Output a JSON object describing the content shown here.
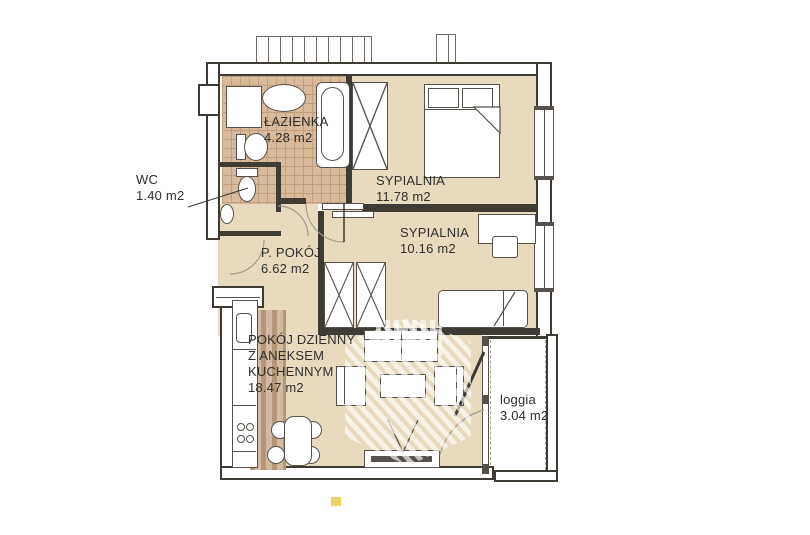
{
  "plan_type": "apartment-floor-plan",
  "rooms": [
    {
      "id": "lazienka",
      "name": "ŁAZIENKA",
      "area": "4.28 m2"
    },
    {
      "id": "wc",
      "name": "WC",
      "area": "1.40 m2"
    },
    {
      "id": "sypialnia-1",
      "name": "SYPIALNIA",
      "area": "11.78 m2"
    },
    {
      "id": "sypialnia-2",
      "name": "SYPIALNIA",
      "area": "10.16 m2"
    },
    {
      "id": "p-pokoj",
      "name": "P. POKÓJ",
      "area": "6.62 m2"
    },
    {
      "id": "pokoj-dzienny",
      "name": "POKÓJ DZIENNY\nZ ANEKSEM\nKUCHENNYM",
      "area": "18.47 m2"
    },
    {
      "id": "loggia",
      "name": "loggia",
      "area": "3.04 m2"
    }
  ],
  "colors": {
    "floor": "#e8dabe",
    "bath_tile": "#d7bb9c",
    "tile_grid": "#c19e7c",
    "wall": "#3e3a34",
    "kitchen_stripe_dark": "#b49678",
    "kitchen_stripe_light": "#d2bca1",
    "accent_dot": "#ecd362",
    "watermark": "#ffffff"
  },
  "furniture_icons": [
    "washing-machine-icon",
    "washbasin-icon",
    "toilet-icon",
    "bathtub-icon",
    "wardrobe-icon",
    "double-bed-icon",
    "single-bed-icon",
    "desk-icon",
    "chair-icon",
    "kitchen-counter-icon",
    "cooktop-icon",
    "kitchen-sink-icon",
    "dining-table-icon",
    "dining-chair-icon",
    "sofa-icon",
    "armchair-icon",
    "coffee-table-icon",
    "tv-stand-icon"
  ]
}
